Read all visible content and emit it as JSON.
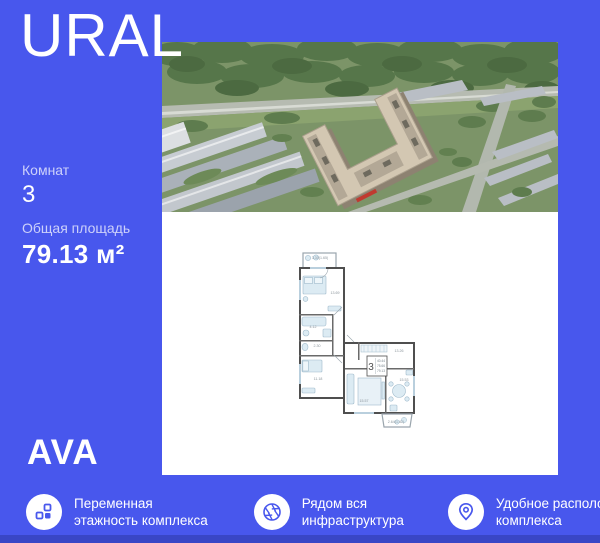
{
  "colors": {
    "background": "#4857ED",
    "bottom_strip": "#3946C6",
    "panel": "#FFFFFF",
    "icon_accent": "#4857ED"
  },
  "brand": {
    "title": "URAL"
  },
  "developer": {
    "logo_text": "AVA"
  },
  "listing": {
    "rooms_label": "Комнат",
    "rooms_value": "3",
    "area_label": "Общая площадь",
    "area_value": "79.13 м²"
  },
  "floor_plan": {
    "stamp": {
      "rooms_value": "3",
      "lines": [
        "40.44",
        "75.66",
        "79.13"
      ]
    },
    "rooms": [
      {
        "name": "balcony-top",
        "area": "3.30(1.65)"
      },
      {
        "name": "bedroom",
        "area": "13.69"
      },
      {
        "name": "bathroom",
        "area": "4.12"
      },
      {
        "name": "wc",
        "area": "2.30"
      },
      {
        "name": "bedroom-2",
        "area": "11.18"
      },
      {
        "name": "hallway",
        "area": "13.26"
      },
      {
        "name": "living-room",
        "area": "15.57"
      },
      {
        "name": "kitchen",
        "area": "15.53"
      },
      {
        "name": "balcony-bottom",
        "area": "2.64(1.82)"
      }
    ]
  },
  "features": [
    {
      "icon": "blocks-icon",
      "line1": "Переменная",
      "line2": "этажность комплекса"
    },
    {
      "icon": "aperture-icon",
      "line1": "Рядом вся",
      "line2": "инфраструктура"
    },
    {
      "icon": "location-pin-icon",
      "line1": "Удобное расположение",
      "line2": "комплекса"
    }
  ]
}
